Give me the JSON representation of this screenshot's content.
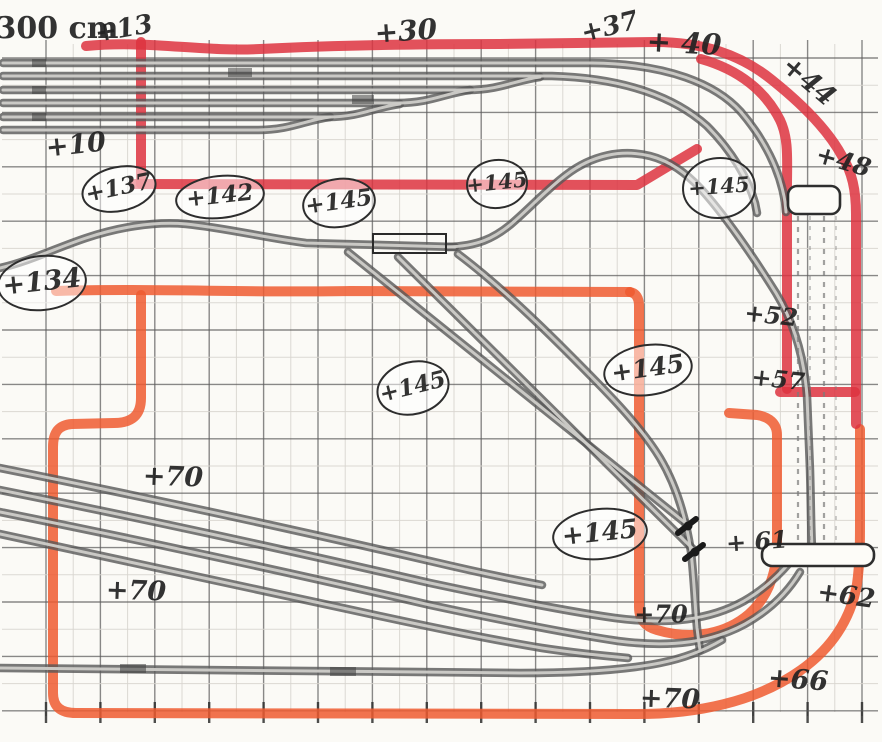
{
  "drawing_title": "hand-drawn model railway track plan on graph paper",
  "colors": {
    "crimson": "#dd3340",
    "orange": "#ef5a30",
    "ink": "#222222",
    "paper": "#fbfaf6",
    "track": "#575757",
    "track-light": "#cfcdc9",
    "grid": "#5c5c5c",
    "grid-minor": "#d8d5cf"
  },
  "grid": {
    "major_step_px": 54.4,
    "x0": 46,
    "y0": 58,
    "cols": 16,
    "rows": 13
  },
  "labels": [
    {
      "name": "scale-label",
      "text": "300 cm",
      "x": 57,
      "y": 30,
      "size": 30,
      "rot": 0,
      "style": "print"
    },
    {
      "name": "elevation-label-13",
      "text": "+13",
      "x": 124,
      "y": 30,
      "size": 26,
      "rot": -10
    },
    {
      "name": "elevation-label-30",
      "text": "+30",
      "x": 406,
      "y": 33,
      "size": 28,
      "rot": -4
    },
    {
      "name": "elevation-label-37",
      "text": "+37",
      "x": 610,
      "y": 28,
      "size": 26,
      "rot": -14
    },
    {
      "name": "elevation-label-40",
      "text": "+ 40",
      "x": 684,
      "y": 45,
      "size": 29,
      "rot": 3
    },
    {
      "name": "elevation-label-44",
      "text": "+44",
      "x": 808,
      "y": 82,
      "size": 27,
      "rot": 40
    },
    {
      "name": "elevation-label-48",
      "text": "+48",
      "x": 843,
      "y": 163,
      "size": 25,
      "rot": 16
    },
    {
      "name": "elevation-label-10",
      "text": "+10",
      "x": 76,
      "y": 146,
      "size": 27,
      "rot": -6
    },
    {
      "name": "elevation-label-137",
      "text": "+137",
      "x": 119,
      "y": 189,
      "size": 23,
      "rot": -12,
      "circled": true,
      "rx": 37,
      "ry": 22
    },
    {
      "name": "elevation-label-142",
      "text": "+142",
      "x": 220,
      "y": 197,
      "size": 23,
      "rot": -6,
      "circled": true,
      "rx": 44,
      "ry": 21
    },
    {
      "name": "elevation-label-145-a",
      "text": "+145",
      "x": 339,
      "y": 203,
      "size": 23,
      "rot": -8,
      "circled": true,
      "rx": 36,
      "ry": 24
    },
    {
      "name": "elevation-label-145-b",
      "text": "+145",
      "x": 497,
      "y": 184,
      "size": 21,
      "rot": -6,
      "circled": true,
      "rx": 30,
      "ry": 24
    },
    {
      "name": "elevation-label-145-c",
      "text": "+145",
      "x": 719,
      "y": 188,
      "size": 21,
      "rot": -4,
      "circled": true,
      "rx": 36,
      "ry": 30
    },
    {
      "name": "elevation-label-134",
      "text": "+134",
      "x": 42,
      "y": 283,
      "size": 27,
      "rot": -6,
      "circled": true,
      "rx": 44,
      "ry": 27
    },
    {
      "name": "elevation-label-145-d",
      "text": "+145",
      "x": 413,
      "y": 388,
      "size": 23,
      "rot": -14,
      "circled": true,
      "rx": 36,
      "ry": 26
    },
    {
      "name": "elevation-label-145-e",
      "text": "+145",
      "x": 648,
      "y": 370,
      "size": 25,
      "rot": -8,
      "circled": true,
      "rx": 44,
      "ry": 25
    },
    {
      "name": "elevation-label-145-f",
      "text": "+145",
      "x": 600,
      "y": 534,
      "size": 26,
      "rot": -6,
      "circled": true,
      "rx": 47,
      "ry": 25
    },
    {
      "name": "elevation-label-52",
      "text": "+52",
      "x": 771,
      "y": 317,
      "size": 24,
      "rot": 6
    },
    {
      "name": "elevation-label-57",
      "text": "+57",
      "x": 778,
      "y": 381,
      "size": 24,
      "rot": 6
    },
    {
      "name": "elevation-label-61",
      "text": "+ 61",
      "x": 757,
      "y": 543,
      "size": 24,
      "rot": -4
    },
    {
      "name": "elevation-label-62",
      "text": "+62",
      "x": 846,
      "y": 597,
      "size": 26,
      "rot": 8
    },
    {
      "name": "elevation-label-66",
      "text": "+66",
      "x": 798,
      "y": 681,
      "size": 27,
      "rot": 4
    },
    {
      "name": "elevation-label-70-a",
      "text": "+70",
      "x": 173,
      "y": 478,
      "size": 27,
      "rot": 2
    },
    {
      "name": "elevation-label-70-b",
      "text": "+70",
      "x": 136,
      "y": 592,
      "size": 27,
      "rot": 2
    },
    {
      "name": "elevation-label-70-c",
      "text": "+70",
      "x": 661,
      "y": 616,
      "size": 24,
      "rot": 0
    },
    {
      "name": "elevation-label-70-d",
      "text": "+70",
      "x": 670,
      "y": 700,
      "size": 27,
      "rot": 2
    }
  ]
}
